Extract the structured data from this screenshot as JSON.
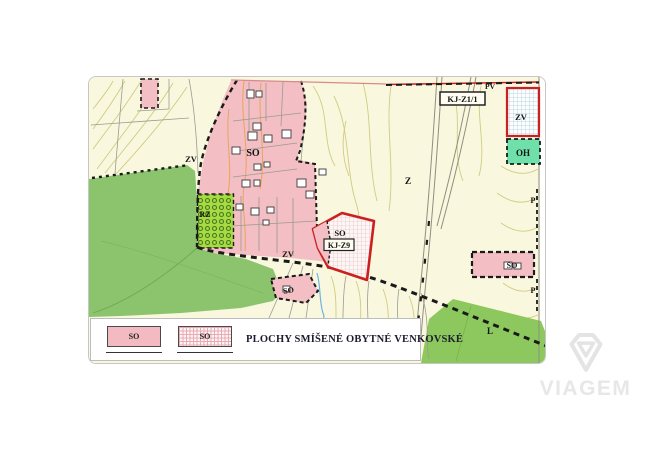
{
  "map": {
    "labels": [
      {
        "id": "so-village",
        "text": "SO"
      },
      {
        "id": "zv-upper",
        "text": "ZV"
      },
      {
        "id": "zv-lower",
        "text": "ZV"
      },
      {
        "id": "rz",
        "text": "RZ"
      },
      {
        "id": "so-kj-z9",
        "text": "SO"
      },
      {
        "id": "kj-z9",
        "text": "KJ-Z9"
      },
      {
        "id": "kj-z1-1",
        "text": "KJ-Z1/1"
      },
      {
        "id": "zv-northeast",
        "text": "ZV"
      },
      {
        "id": "oh",
        "text": "OH"
      },
      {
        "id": "z",
        "text": "Z"
      },
      {
        "id": "pv",
        "text": "PV"
      },
      {
        "id": "so-east",
        "text": "SO"
      },
      {
        "id": "so-south",
        "text": "SO"
      },
      {
        "id": "l",
        "text": "L"
      },
      {
        "id": "p-upper",
        "text": "P"
      },
      {
        "id": "p-lower",
        "text": "P"
      }
    ],
    "colors": {
      "background_cream": "#faf7df",
      "residential_pink": "#f3bec4",
      "field_green": "#8cc46e",
      "meadow_green": "#8cc85e",
      "orchard_green": "#a9d943",
      "oh_green": "#6fe0aa",
      "boundary_red": "#cc2020",
      "contour_olive": "#cfcc82",
      "contour_orange": "#e8a55e",
      "water_blue": "#6ab5e2"
    }
  },
  "legend": {
    "items": [
      {
        "code": "SO",
        "variant": "solid"
      },
      {
        "code": "SO",
        "variant": "hatched"
      }
    ],
    "title": "PLOCHY SMÍŠENÉ OBYTNÉ VENKOVSKÉ"
  },
  "watermark": {
    "text": "VIAGEM"
  }
}
